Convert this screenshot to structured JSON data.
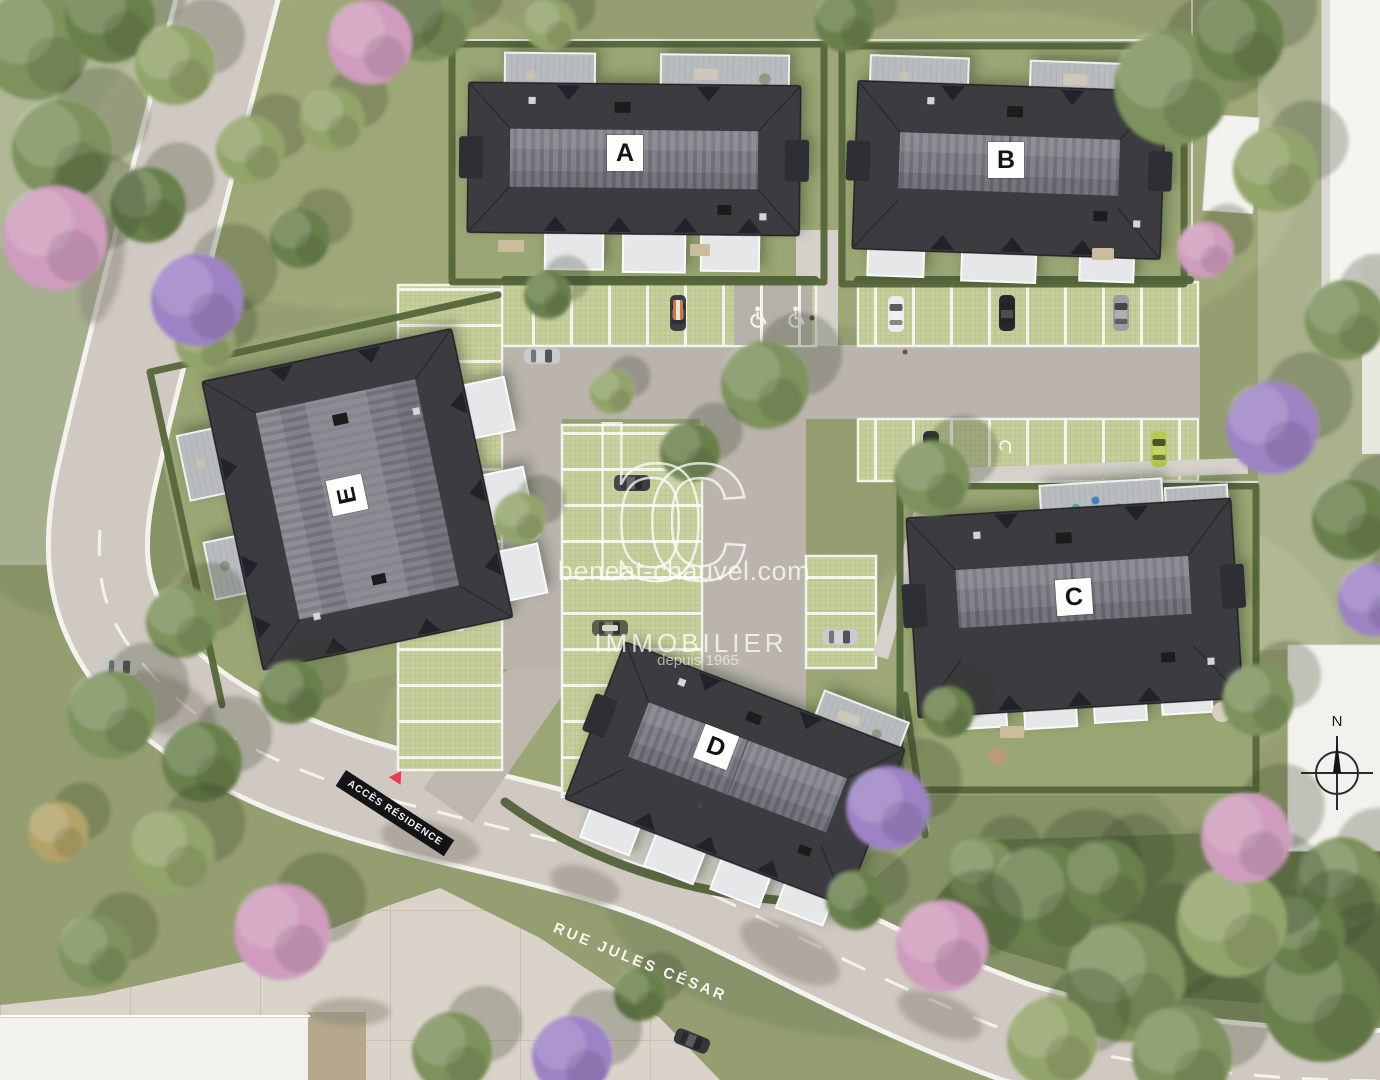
{
  "buildings": [
    {
      "label": "A"
    },
    {
      "label": "B"
    },
    {
      "label": "C"
    },
    {
      "label": "D"
    },
    {
      "label": "E"
    }
  ],
  "watermark": {
    "logo": "bc",
    "website": "beneat-chauvel.com",
    "brand": "IMMOBILIER",
    "tagline": "depuis 1965"
  },
  "signs": {
    "residence_access": "ACCÈS RÉSIDENCE",
    "street_name": "RUE JULES CÉSAR"
  },
  "compass": {
    "north_label": "N"
  },
  "icons": {
    "handicap_parking": "wheelchair-icon",
    "ev_charging": "ev-charging-icon",
    "compass": "compass-rose-icon",
    "access_marker": "red-triangle-icon"
  },
  "colors": {
    "roof_dark": "#3b3b41",
    "roof_ridge": "#82828a",
    "grass": "#949e71",
    "parking_paver": "#c6ce9b",
    "road": "#cfc9c2",
    "accent_red": "#e63c52",
    "hedge": "#55663b",
    "white_building": "#f4f4f1"
  }
}
